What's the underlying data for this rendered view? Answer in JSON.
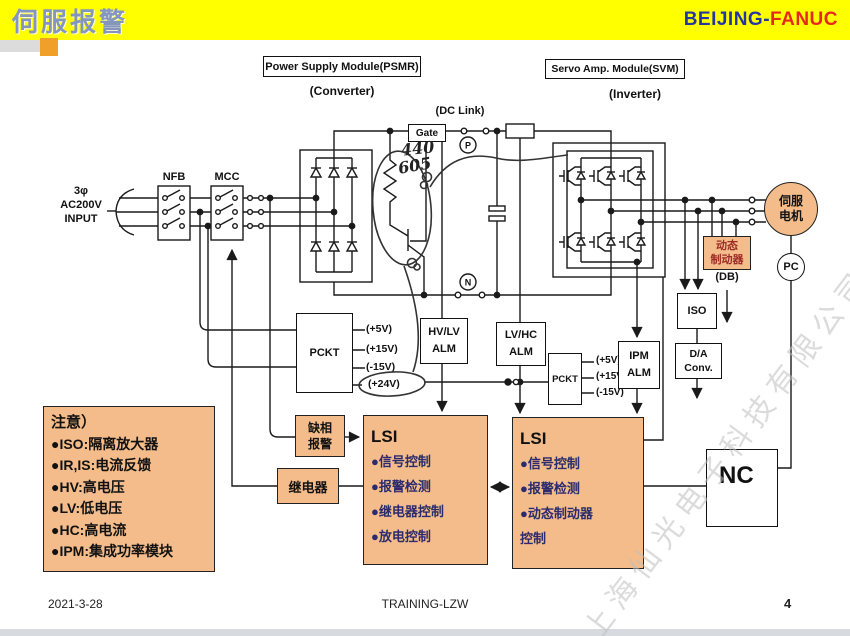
{
  "header": {
    "title": "伺服报警",
    "brand_blue": "BEIJING-",
    "brand_red": "FANUC"
  },
  "modules": {
    "psmr": "Power Supply Module(PSMR)",
    "psmr_sub": "(Converter)",
    "svm": "Servo Amp. Module(SVM)",
    "svm_sub": "(Inverter)"
  },
  "labels": {
    "dc_link": "(DC Link)",
    "gate": "Gate",
    "nfb": "NFB",
    "mcc": "MCC",
    "input_1": "3φ",
    "input_2": "AC200V",
    "input_3": "INPUT",
    "p": "P",
    "n": "N",
    "db": "(DB)",
    "hand_1": "440",
    "hand_2": "605"
  },
  "blocks": {
    "pckt1": "PCKT",
    "pckt1_outputs": [
      "(+5V)",
      "(+15V)",
      "(-15V)",
      "(+24V)"
    ],
    "pckt2": "PCKT",
    "pckt2_outputs": [
      "(+5V)",
      "(+15V)",
      "(-15V)"
    ],
    "hvlv_alm": [
      "HV/LV",
      "ALM"
    ],
    "lvhc_alm": [
      "LV/HC",
      "ALM"
    ],
    "ipm_alm": [
      "IPM",
      "ALM"
    ],
    "iso": "ISO",
    "da_conv": [
      "D/A",
      "Conv."
    ],
    "servo_motor": [
      "伺服",
      "电机"
    ],
    "pc": "PC",
    "dynamic_brake": [
      "动态",
      "制动器"
    ],
    "phase_loss": [
      "缺相",
      "报警"
    ],
    "relay": "继电器",
    "nc": "NC"
  },
  "note": {
    "title": "注意）",
    "items": [
      "●ISO:隔离放大器",
      "●IR,IS:电流反馈",
      "●HV:高电压",
      "●LV:低电压",
      "●HC:高电流",
      "●IPM:集成功率模块"
    ]
  },
  "lsi1": {
    "title": "LSI",
    "items": [
      "●信号控制",
      "●报警检测",
      "●继电器控制",
      "●放电控制"
    ]
  },
  "lsi2": {
    "title": "LSI",
    "items": [
      "●信号控制",
      "●报警检测",
      "●动态制动器",
      "控制"
    ]
  },
  "watermark": "上海仙光电子科技有限公司",
  "footer": {
    "date": "2021-3-28",
    "center": "TRAINING-LZW",
    "page": "4"
  },
  "colors": {
    "header_bg": "#ffff00",
    "title_blue": "#8495be",
    "brand_blue": "#2337a0",
    "brand_red": "#e5281e",
    "box_orange": "#f3bc8a",
    "brake_text": "#9e2b25",
    "lsi_text": "#2b2b6e",
    "accent_square": "#f0a028",
    "footer_strip": "#d7dbe0",
    "watermark": "#bfbfbf"
  }
}
